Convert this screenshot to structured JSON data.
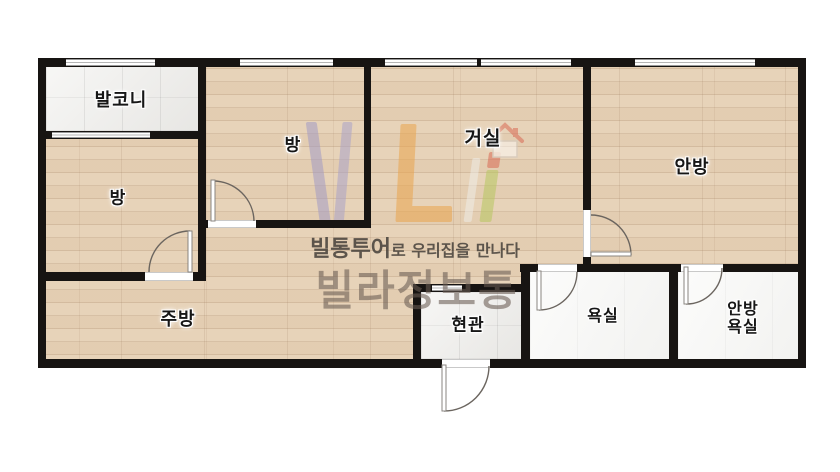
{
  "floorplan": {
    "rooms": {
      "balcony": {
        "label": "발코니"
      },
      "room_left": {
        "label": "방"
      },
      "room_middle": {
        "label": "방"
      },
      "living": {
        "label": "거실"
      },
      "master": {
        "label": "안방"
      },
      "kitchen": {
        "label": "주방"
      },
      "entrance": {
        "label": "현관"
      },
      "bath": {
        "label": "욕실"
      },
      "master_bath": {
        "label_line1": "안방",
        "label_line2": "욕실"
      }
    },
    "watermark": {
      "tagline_bold": "빌통투어",
      "tagline_rest": "로 우리집을 만나다",
      "brand": "빌라정보통"
    },
    "colors": {
      "wall": "#171412",
      "wood_floor": "#e7d3b9",
      "tile_floor": "#efeeeb",
      "bath_floor": "#f7f7f5",
      "logo_purple": "#a39bc4",
      "logo_orange": "#eaa54d",
      "logo_green": "#b7c75f",
      "logo_red": "#d96a55",
      "brand_text": "#695c52",
      "tagline_text": "#45403a"
    }
  }
}
